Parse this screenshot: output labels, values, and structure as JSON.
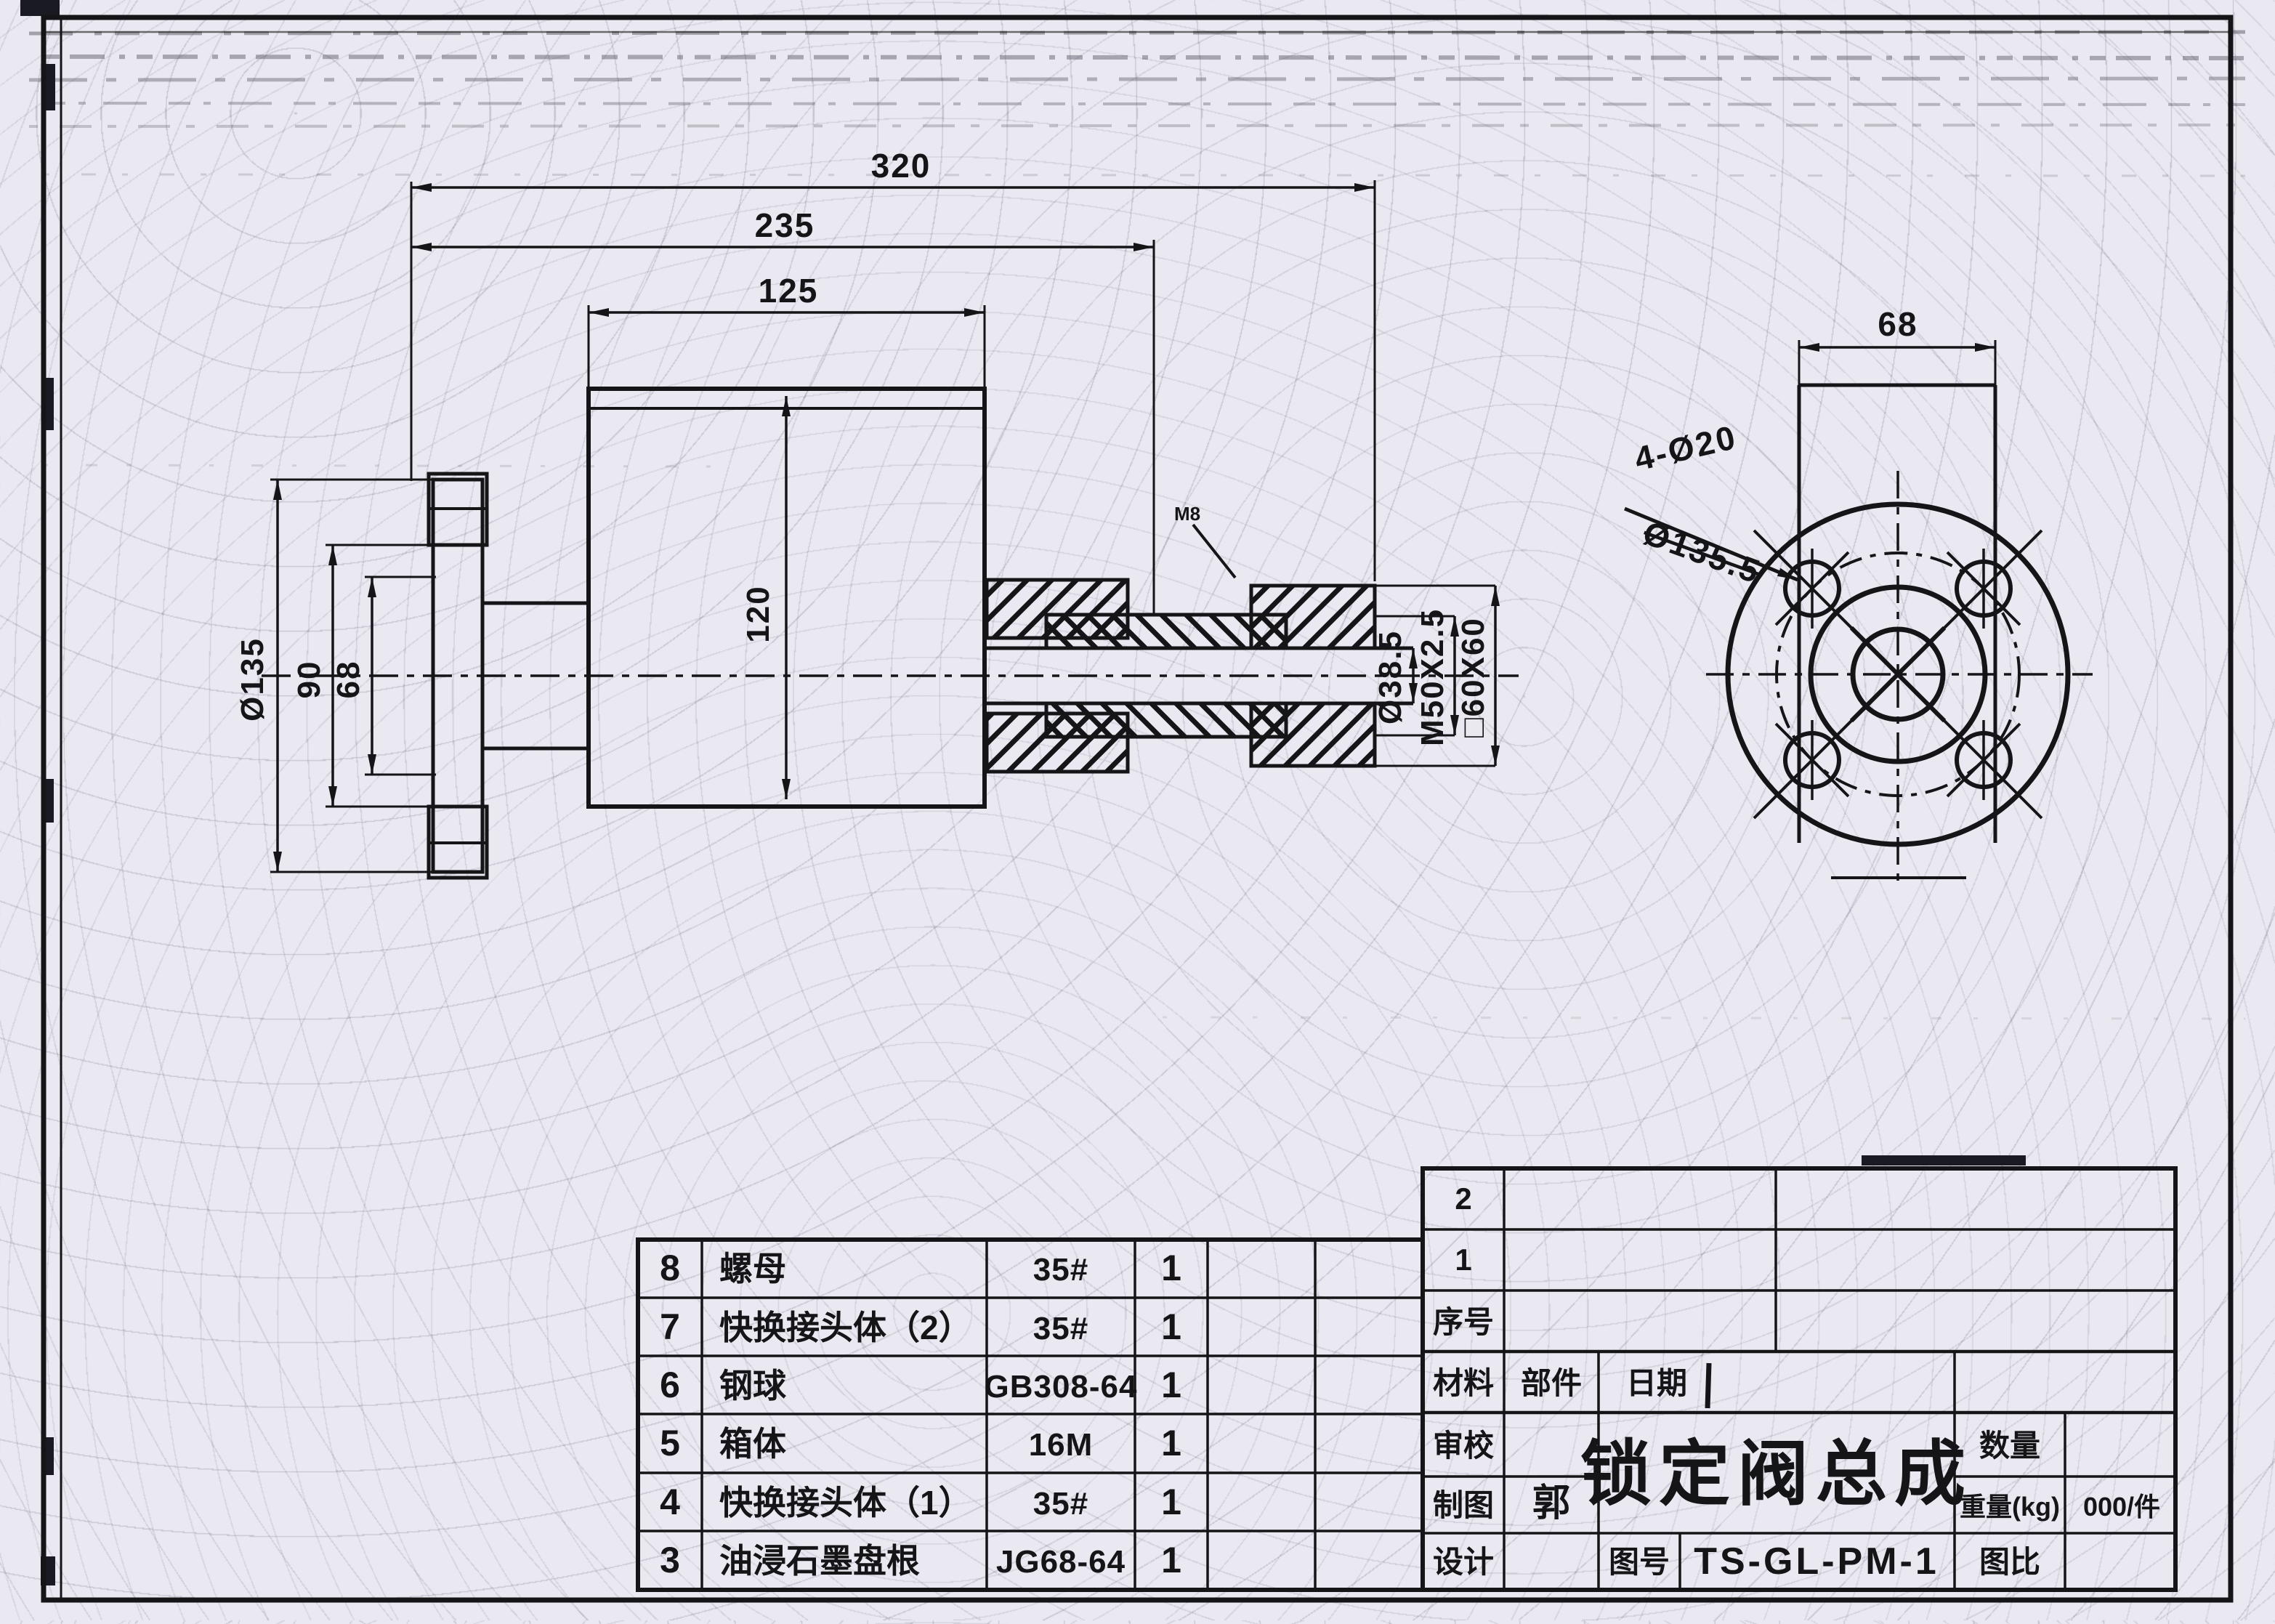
{
  "dims": {
    "overall": "320",
    "body": "235",
    "box_w": "125",
    "box_h": "120",
    "flange_od": "Ø135",
    "flange_mid": "90",
    "flange_in": "68",
    "bore": "Ø38.5",
    "thread": "M50X2.5",
    "square": "□60X60",
    "tap": "M8"
  },
  "end_view": {
    "width": "68",
    "holes": "4-Ø20",
    "bolt_circle": "Ø135.5"
  },
  "parts_table": {
    "rows": [
      {
        "no": "8",
        "name": "螺母",
        "spec": "35#",
        "qty": "1"
      },
      {
        "no": "7",
        "name": "快换接头体（2）",
        "spec": "35#",
        "qty": "1"
      },
      {
        "no": "6",
        "name": "钢球",
        "spec": "GB308-64",
        "qty": "1"
      },
      {
        "no": "5",
        "name": "箱体",
        "spec": "16M",
        "qty": "1"
      },
      {
        "no": "4",
        "name": "快换接头体（1）",
        "spec": "35#",
        "qty": "1"
      },
      {
        "no": "3",
        "name": "油浸石墨盘根",
        "spec": "JG68-64",
        "qty": "1"
      }
    ]
  },
  "title_block": {
    "row2": "2",
    "row1": "1",
    "seq_label": "序号",
    "material_label": "材料",
    "part_label": "部件",
    "date_label": "日期",
    "review_label": "审校",
    "draft_label": "制图",
    "draft_value": "郭",
    "design_label": "设计",
    "title": "锁定阀总成",
    "qty_label": "数量",
    "weight_label": "重量(kg)",
    "weight_value": "000/件",
    "scale_label": "图比",
    "dwgno_label": "图号",
    "dwgno_value": "TS-GL-PM-1"
  }
}
